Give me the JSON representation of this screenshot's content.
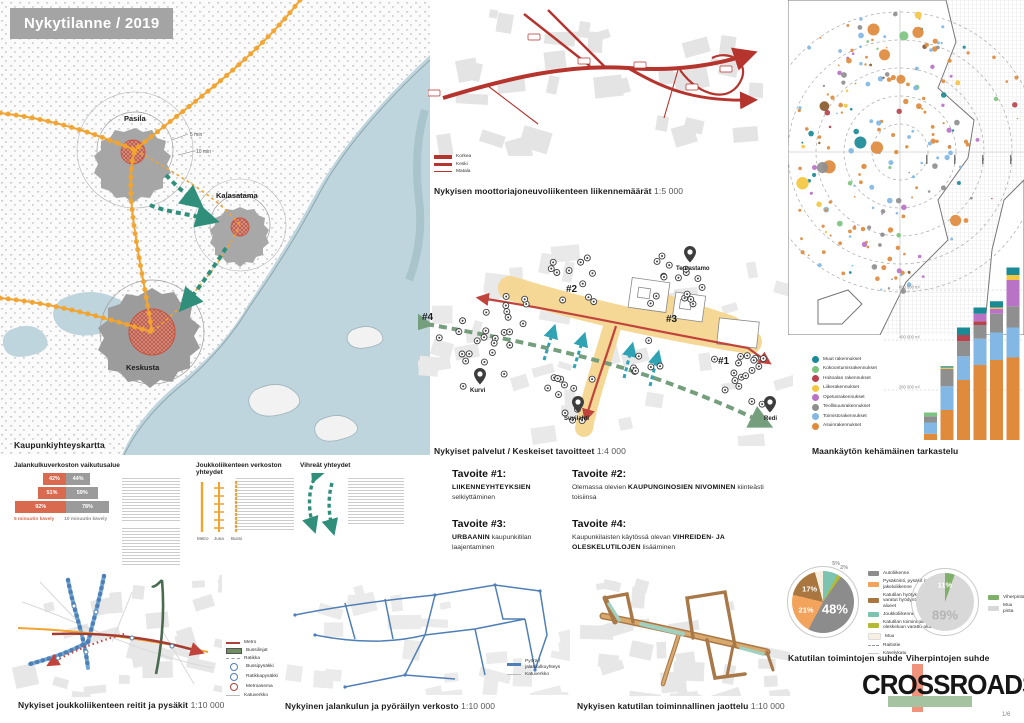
{
  "meta": {
    "page_title": "Nykytilanne / 2019",
    "page_number": "1/6",
    "brand": "CROSSROADS"
  },
  "city_map": {
    "caption": "Kaupunkiyhteyskartta",
    "districts": {
      "pasila": "Pasila",
      "kalasatama": "Kalasatama",
      "keskusta": "Keskusta"
    },
    "annotations": {
      "five": "5 min",
      "ten": "10 min"
    }
  },
  "walk_legend": {
    "title": "Jalankulkuverkoston vaikutusalue",
    "series_a": "5 minuutin kävely",
    "series_b": "10 minuutin kävely"
  },
  "transit_legend": {
    "title": "Joukkoliikenteen verkoston yhteydet",
    "modes": [
      "Metro",
      "Juna",
      "Bussi"
    ]
  },
  "green_legend": {
    "title": "Vihreät yhteydet"
  },
  "traffic_map": {
    "caption": "Nykyisen moottoriajoneuvoliikenteen liikennemäärät",
    "scale": "1:5 000",
    "legend": [
      "Korkea",
      "Keski",
      "Matala"
    ]
  },
  "services_map": {
    "caption": "Nykyiset palvelut / Keskeiset tavoitteet",
    "scale": "1:4 000",
    "labels": {
      "teurastamo": "Teurastamo",
      "kurvi": "Kurvi",
      "suvilahti": "Suvilahti",
      "redi": "Redi"
    },
    "targets": {
      "t1": "#1",
      "t2": "#2",
      "t3": "#3",
      "t4": "#4"
    }
  },
  "goals": [
    {
      "title": "Tavoite #1:",
      "pre": "",
      "bold": "LIIKENNEYHTEYKSIEN",
      "post": " selkiyttäminen"
    },
    {
      "title": "Tavoite #2:",
      "pre": "Olemassa olevien ",
      "bold": "KAUPUNGINOSIEN NIVOMINEN",
      "post": " kiinteästi toisiinsa"
    },
    {
      "title": "Tavoite #3:",
      "pre": "",
      "bold": "URBAANIN",
      "post": " kaupunkitilan laajentaminen"
    },
    {
      "title": "Tavoite #4:",
      "pre": "Kaupunkilaisten käytössä olevan ",
      "bold": "VIHREIDEN- JA OLESKELUTILOJEN",
      "post": " lisääminen"
    }
  ],
  "land_use": {
    "caption": "Maankäytön kehämäinen tarkastelu"
  },
  "transit_routes_map": {
    "caption": "Nykyiset joukkoliikenteen reitit ja pysäkit",
    "scale": "1:10 000",
    "legend": [
      {
        "label": "Metro",
        "symbol": "line",
        "color": "#b0413c"
      },
      {
        "label": "Bussilinjat",
        "symbol": "band",
        "color": "#6f8f63"
      },
      {
        "label": "Ratikka",
        "symbol": "dash",
        "color": "#9a9a9a"
      },
      {
        "label": "Bussipysäkki",
        "symbol": "circle",
        "color": "#4f7fb5"
      },
      {
        "label": "Ratikkapysäkki",
        "symbol": "circle",
        "color": "#4f7fb5"
      },
      {
        "label": "Metroasema",
        "symbol": "circle",
        "color": "#b0413c"
      },
      {
        "label": "Katuverkko",
        "symbol": "thin",
        "color": "#bbbbbb"
      }
    ]
  },
  "bike_map": {
    "caption": "Nykyinen jalankulun ja pyöräilyn verkosto",
    "scale": "1:10 000",
    "legend": [
      {
        "label": "Pyörä / jalankulkuyhteys",
        "symbol": "line",
        "color": "#4f7fb5"
      },
      {
        "label": "Katuverkko",
        "symbol": "thin",
        "color": "#bbbbbb"
      }
    ]
  },
  "street_map": {
    "caption": "Nykyisen katutilan toiminnallinen jaottelu",
    "scale": "1:10 000"
  },
  "pies_section": {
    "caption_left": "Katutilan toimintojen suhde",
    "caption_right": "Viherpintojen suhde"
  },
  "chart_data": [
    {
      "id": "walkability",
      "type": "bar",
      "title": "Jalankulkuverkoston vaikutusalue",
      "categories": [
        "",
        "",
        ""
      ],
      "series": [
        {
          "name": "5 minuutin kävely",
          "color": "#d96a4f",
          "values": [
            42,
            51,
            92
          ]
        },
        {
          "name": "10 minuutin kävely",
          "color": "#9b9b9b",
          "values": [
            44,
            59,
            78
          ]
        }
      ],
      "unit": "%"
    },
    {
      "id": "land-use-rings",
      "type": "bar",
      "stacked": true,
      "title": "Maankäytön kehämäinen tarkastelu",
      "categories": [
        "",
        "",
        "",
        "",
        "",
        ""
      ],
      "ylabel": "m²",
      "ylim": [
        0,
        700000
      ],
      "yticks": [
        {
          "value": 200000,
          "label": "200 000 m²"
        },
        {
          "value": 400000,
          "label": "400 000 m²"
        },
        {
          "value": 600000,
          "label": "600 000 m²"
        }
      ],
      "series": [
        {
          "name": "Asuinrakennukset",
          "color": "#e08a3c",
          "values": [
            25000,
            120000,
            240000,
            300000,
            320000,
            330000
          ]
        },
        {
          "name": "Toimistorakennukset",
          "color": "#82b8e3",
          "values": [
            45000,
            95000,
            95000,
            105000,
            110000,
            120000
          ]
        },
        {
          "name": "Teollisuusrakennukset",
          "color": "#8f8f8f",
          "values": [
            25000,
            70000,
            60000,
            55000,
            75000,
            85000
          ]
        },
        {
          "name": "Hoitoalan rakennukset",
          "color": "#b8434e",
          "values": [
            0,
            0,
            25000,
            15000,
            0,
            0
          ]
        },
        {
          "name": "Opetusrakennukset",
          "color": "#b973c6",
          "values": [
            0,
            0,
            0,
            30000,
            20000,
            105000
          ]
        },
        {
          "name": "Liikerakennukset",
          "color": "#f3c73f",
          "values": [
            0,
            5000,
            0,
            0,
            5000,
            20000
          ]
        },
        {
          "name": "Kokoontumisrakennukset",
          "color": "#7cc47f",
          "values": [
            15000,
            0,
            0,
            0,
            0,
            0
          ]
        },
        {
          "name": "Muut rakennukset",
          "color": "#1b8a97",
          "values": [
            0,
            5000,
            30000,
            25000,
            25000,
            30000
          ]
        }
      ],
      "legend_order": [
        "Muut rakennukset",
        "Kokoontumisrakennukset",
        "Hoitoalan rakennukset",
        "Liikerakennukset",
        "Opetusrakennukset",
        "Teollisuusrakennukset",
        "Toimistorakennukset",
        "Asuinrakennukset"
      ],
      "legend_position": "left"
    },
    {
      "id": "street-functions",
      "type": "pie",
      "title": "Katutilan toimintojen suhde",
      "slices": [
        {
          "label": "Autoliikenne",
          "value": 48,
          "color": "#8c8c8c",
          "show_pct": true
        },
        {
          "label": "Pysäköinti, pysäkit ja jakeluliikenne",
          "value": 21,
          "color": "#f2a45c",
          "show_pct": true
        },
        {
          "label": "Katutilan hyötykäyttöön varatut hyödyntämättömät alueet",
          "value": 17,
          "color": "#a9763f",
          "show_pct": true
        },
        {
          "label": "Joukkoliikenne",
          "value": 5,
          "color": "#7cc4b0",
          "show_pct": true
        },
        {
          "label": "Katutilan toiminnoille ja oleskeluun varattu alue",
          "value": 2,
          "color": "#b5b832",
          "show_pct": true
        },
        {
          "label": "Muu",
          "value": 7,
          "color": "#f7efdf",
          "show_pct": false
        }
      ],
      "draw_order": [
        3,
        4,
        0,
        1,
        2,
        5
      ],
      "extra_legend": [
        {
          "label": "Raitiotie",
          "symbol": "dash"
        },
        {
          "label": "Kävelykatu",
          "symbol": "thin"
        }
      ]
    },
    {
      "id": "green-surfaces",
      "type": "pie",
      "title": "Viherpintojen suhde",
      "slices": [
        {
          "label": "Viherpinta",
          "value": 11,
          "color": "#7fb069",
          "show_pct": true
        },
        {
          "label": "Muu pinta",
          "value": 89,
          "color": "#d8d8d8",
          "show_pct": true
        }
      ],
      "draw_order": [
        0,
        1
      ]
    }
  ]
}
